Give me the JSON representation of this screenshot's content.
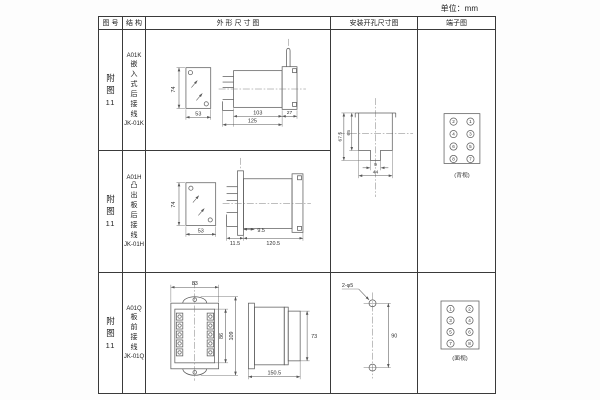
{
  "unit": "单位：mm",
  "header": {
    "fig": "图 号",
    "struct": "结 构",
    "outline": "外 形 尺 寸 图",
    "mount": "安装开孔尺寸图",
    "terminal": "端子图"
  },
  "figure_label": [
    "附",
    "图",
    "11"
  ],
  "row1": {
    "model": "A01K",
    "type": [
      "嵌",
      "入",
      "式",
      "后",
      "接",
      "线"
    ],
    "code": "JK-01K",
    "dims": {
      "front_h": "74",
      "front_w": "53",
      "body": "103",
      "total": "125",
      "tail": "27"
    }
  },
  "row2": {
    "model": "A01H",
    "type": [
      "凸",
      "出",
      "板",
      "后",
      "接",
      "线"
    ],
    "code": "JK-01H",
    "dims": {
      "front_h": "74",
      "front_w": "53",
      "gap": "9.5",
      "pin": "11.5",
      "body": "120.5"
    }
  },
  "row3": {
    "model": "A01Q",
    "type": [
      "板",
      "前",
      "接",
      "线"
    ],
    "code": "JK-01Q",
    "dims": {
      "front_w": "83",
      "inner_h": "86",
      "outer_h": "109",
      "side_h": "73",
      "side_l": "150.5"
    }
  },
  "mount12": {
    "outer": "67.5",
    "inner": "65",
    "notch": "9",
    "width": "44"
  },
  "mount3": {
    "hole_label": "2-φ5",
    "spacing": "90"
  },
  "term12": {
    "left": [
      "2",
      "4",
      "6",
      "8"
    ],
    "right": [
      "1",
      "3",
      "5",
      "7"
    ],
    "caption": "(背视)"
  },
  "term3": {
    "left": [
      "1",
      "3",
      "5",
      "7"
    ],
    "right": [
      "2",
      "4",
      "6",
      "8"
    ],
    "caption": "(面视)"
  }
}
